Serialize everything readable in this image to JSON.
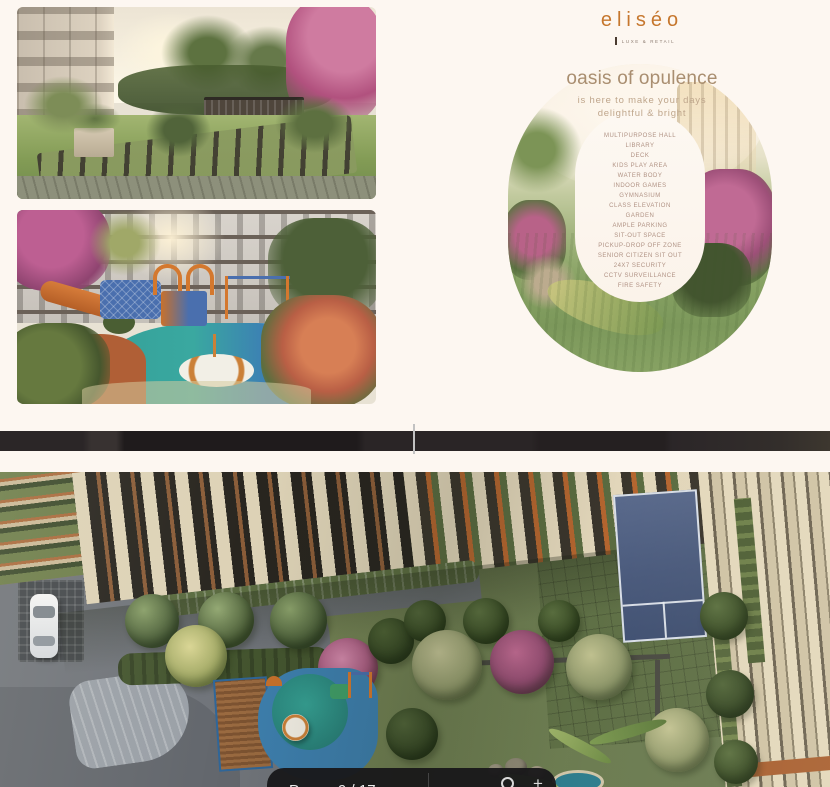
{
  "brochure": {
    "logo": {
      "wordmark": "eliséo",
      "tagline": "LUXE & RETAIL"
    },
    "headline": "oasis of opulence",
    "tagline_line1": "is here to make your days",
    "tagline_line2": "delightful & bright",
    "amenities": [
      "MULTIPURPOSE HALL",
      "LIBRARY",
      "DECK",
      "KIDS PLAY AREA",
      "WATER BODY",
      "INDOOR GAMES",
      "GYMNASIUM",
      "CLASS ELEVATION",
      "GARDEN",
      "AMPLE PARKING",
      "SIT-OUT SPACE",
      "PICKUP-DROP OFF ZONE",
      "SENIOR CITIZEN SIT OUT",
      "24X7 SECURITY",
      "CCTV SURVEILLANCE",
      "FIRE SAFETY"
    ]
  },
  "viewer": {
    "page_label": "Page",
    "page_indicator": "9 / 17",
    "icons": {
      "zoom_magnifier": "magnifier-icon",
      "zoom_plus": "+"
    }
  },
  "colors": {
    "page_background": "#fdf7f1",
    "logo_orange": "#c6772e",
    "heading_brown": "#a98e70",
    "amenity_text": "#b09284",
    "page_edge_dark": "#272223",
    "toolbar_background": "#181719",
    "court_blue": "#49597b",
    "lawn_green": "#6f7f52"
  }
}
